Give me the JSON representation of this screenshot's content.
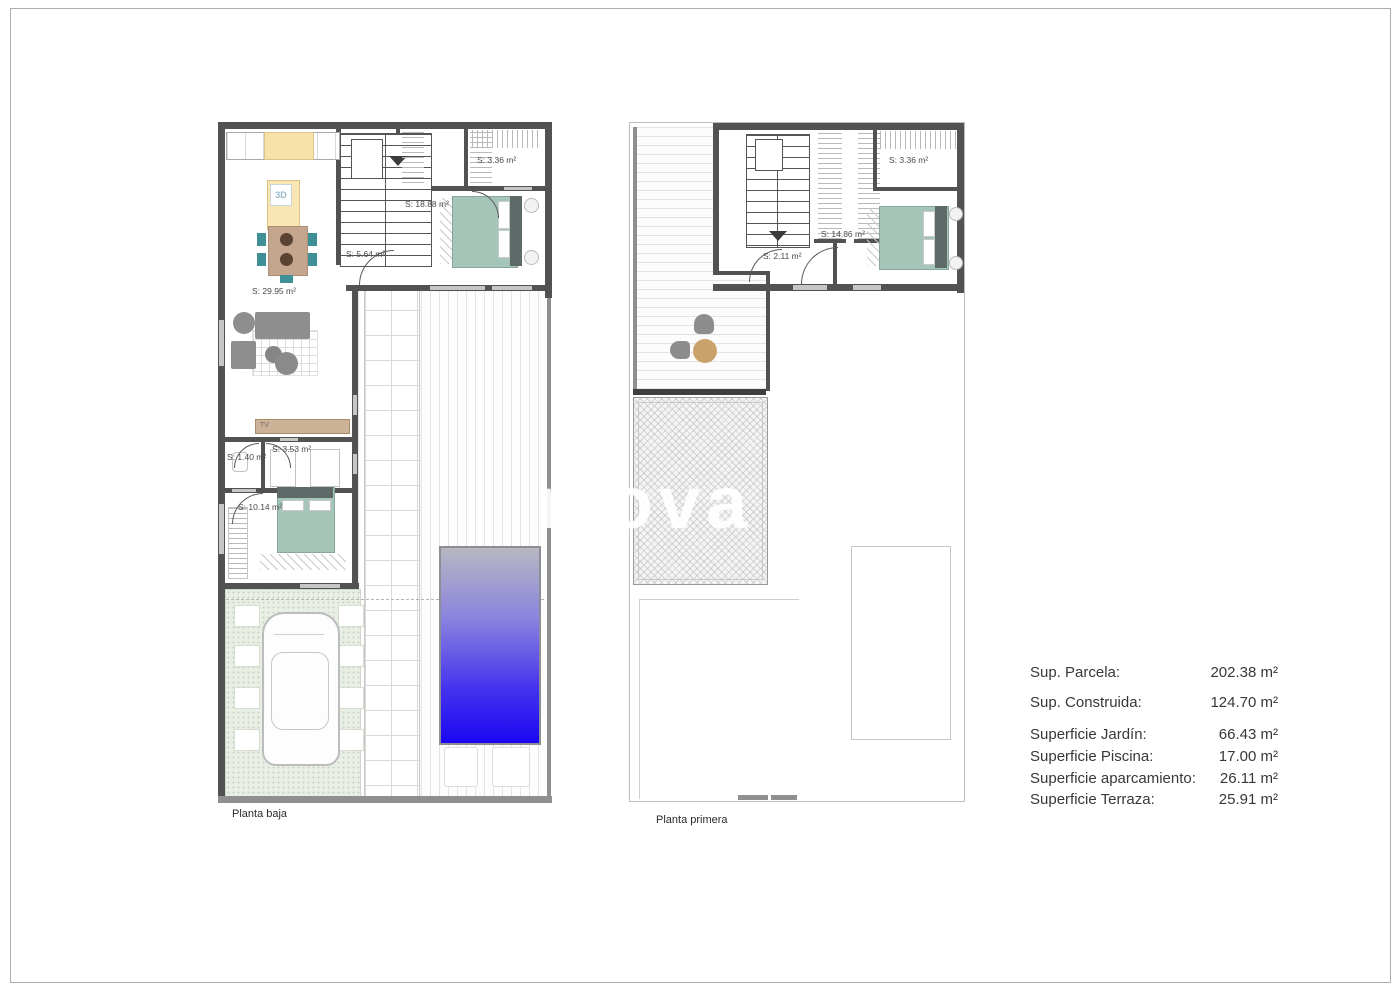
{
  "ground_floor": {
    "title": "Planta baja",
    "labels": {
      "living": "S: 29.95 m²",
      "hall": "S: 5.64 m²",
      "corridor": "S: 18.88 m²",
      "storage": "S: 3.36 m²",
      "wc": "S: 1.40 m²",
      "bathroom": "S: 3.53 m²",
      "bedroom": "S: 10.14 m²",
      "tv_unit": "TV",
      "view3d_badge": "3D"
    }
  },
  "first_floor": {
    "title": "Planta primera",
    "labels": {
      "hall": "S: 2.11 m²",
      "bedroom": "S: 14.86 m²",
      "closet": "S: 3.36 m²"
    }
  },
  "watermark": "mova",
  "areas": {
    "rows": [
      {
        "label": "Sup. Parcela:",
        "value": "202.38 m²"
      },
      {
        "label": "Sup. Construida:",
        "value": "124.70 m²"
      },
      {
        "label": "Superficie Jardín:",
        "value": "66.43 m²"
      },
      {
        "label": "Superficie Piscina:",
        "value": "17.00 m²"
      },
      {
        "label": "Superficie aparcamiento:",
        "value": "26.11 m²"
      },
      {
        "label": "Superficie Terraza:",
        "value": "25.91 m²"
      }
    ]
  },
  "colors": {
    "wall": "#525252",
    "bed_teal": "#a5c5b8",
    "kitchen_yellow": "#f7e2ac",
    "table_tan": "#c4a68f",
    "chair_teal": "#3e8f96",
    "pool_blue": "#1b07f2",
    "garden_green": "#e9efe5"
  }
}
